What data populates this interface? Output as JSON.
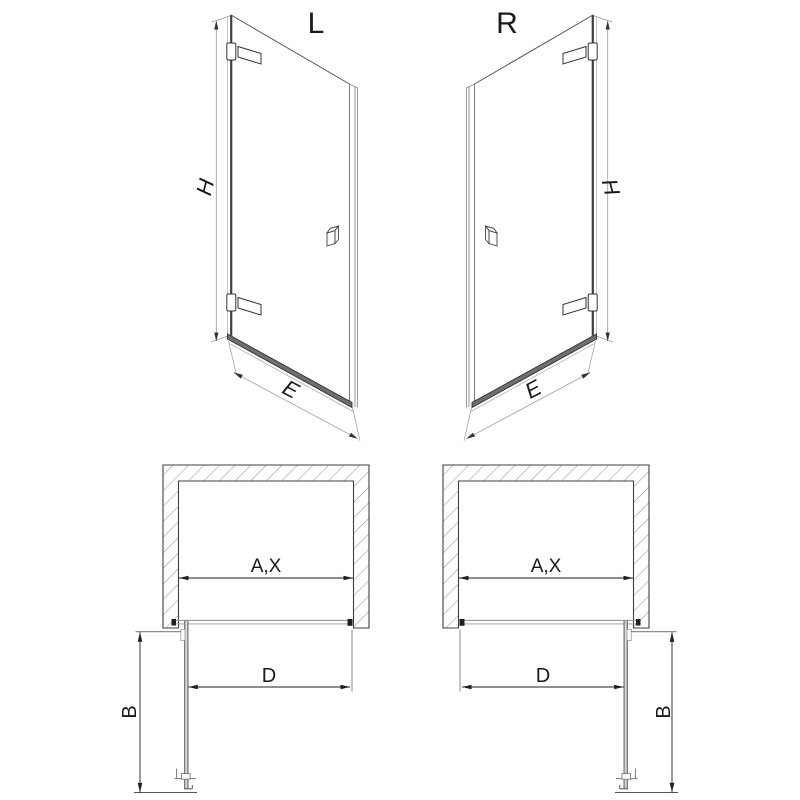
{
  "colors": {
    "background": "#ffffff",
    "line_dark": "#2e2e2e",
    "line_gray": "#8a8a8a",
    "glass_light": "#b5b5b5",
    "rail_fill": "#6f6f6f",
    "text": "#1a1a1a"
  },
  "views": {
    "front_left": {
      "variant_label": "L",
      "height_dim": "H",
      "width_dim": "E"
    },
    "front_right": {
      "variant_label": "R",
      "height_dim": "H",
      "width_dim": "E"
    },
    "plan_left": {
      "opening_dim": "A,X",
      "door_dim": "D",
      "depth_dim": "B"
    },
    "plan_right": {
      "opening_dim": "A,X",
      "door_dim": "D",
      "depth_dim": "B"
    }
  }
}
